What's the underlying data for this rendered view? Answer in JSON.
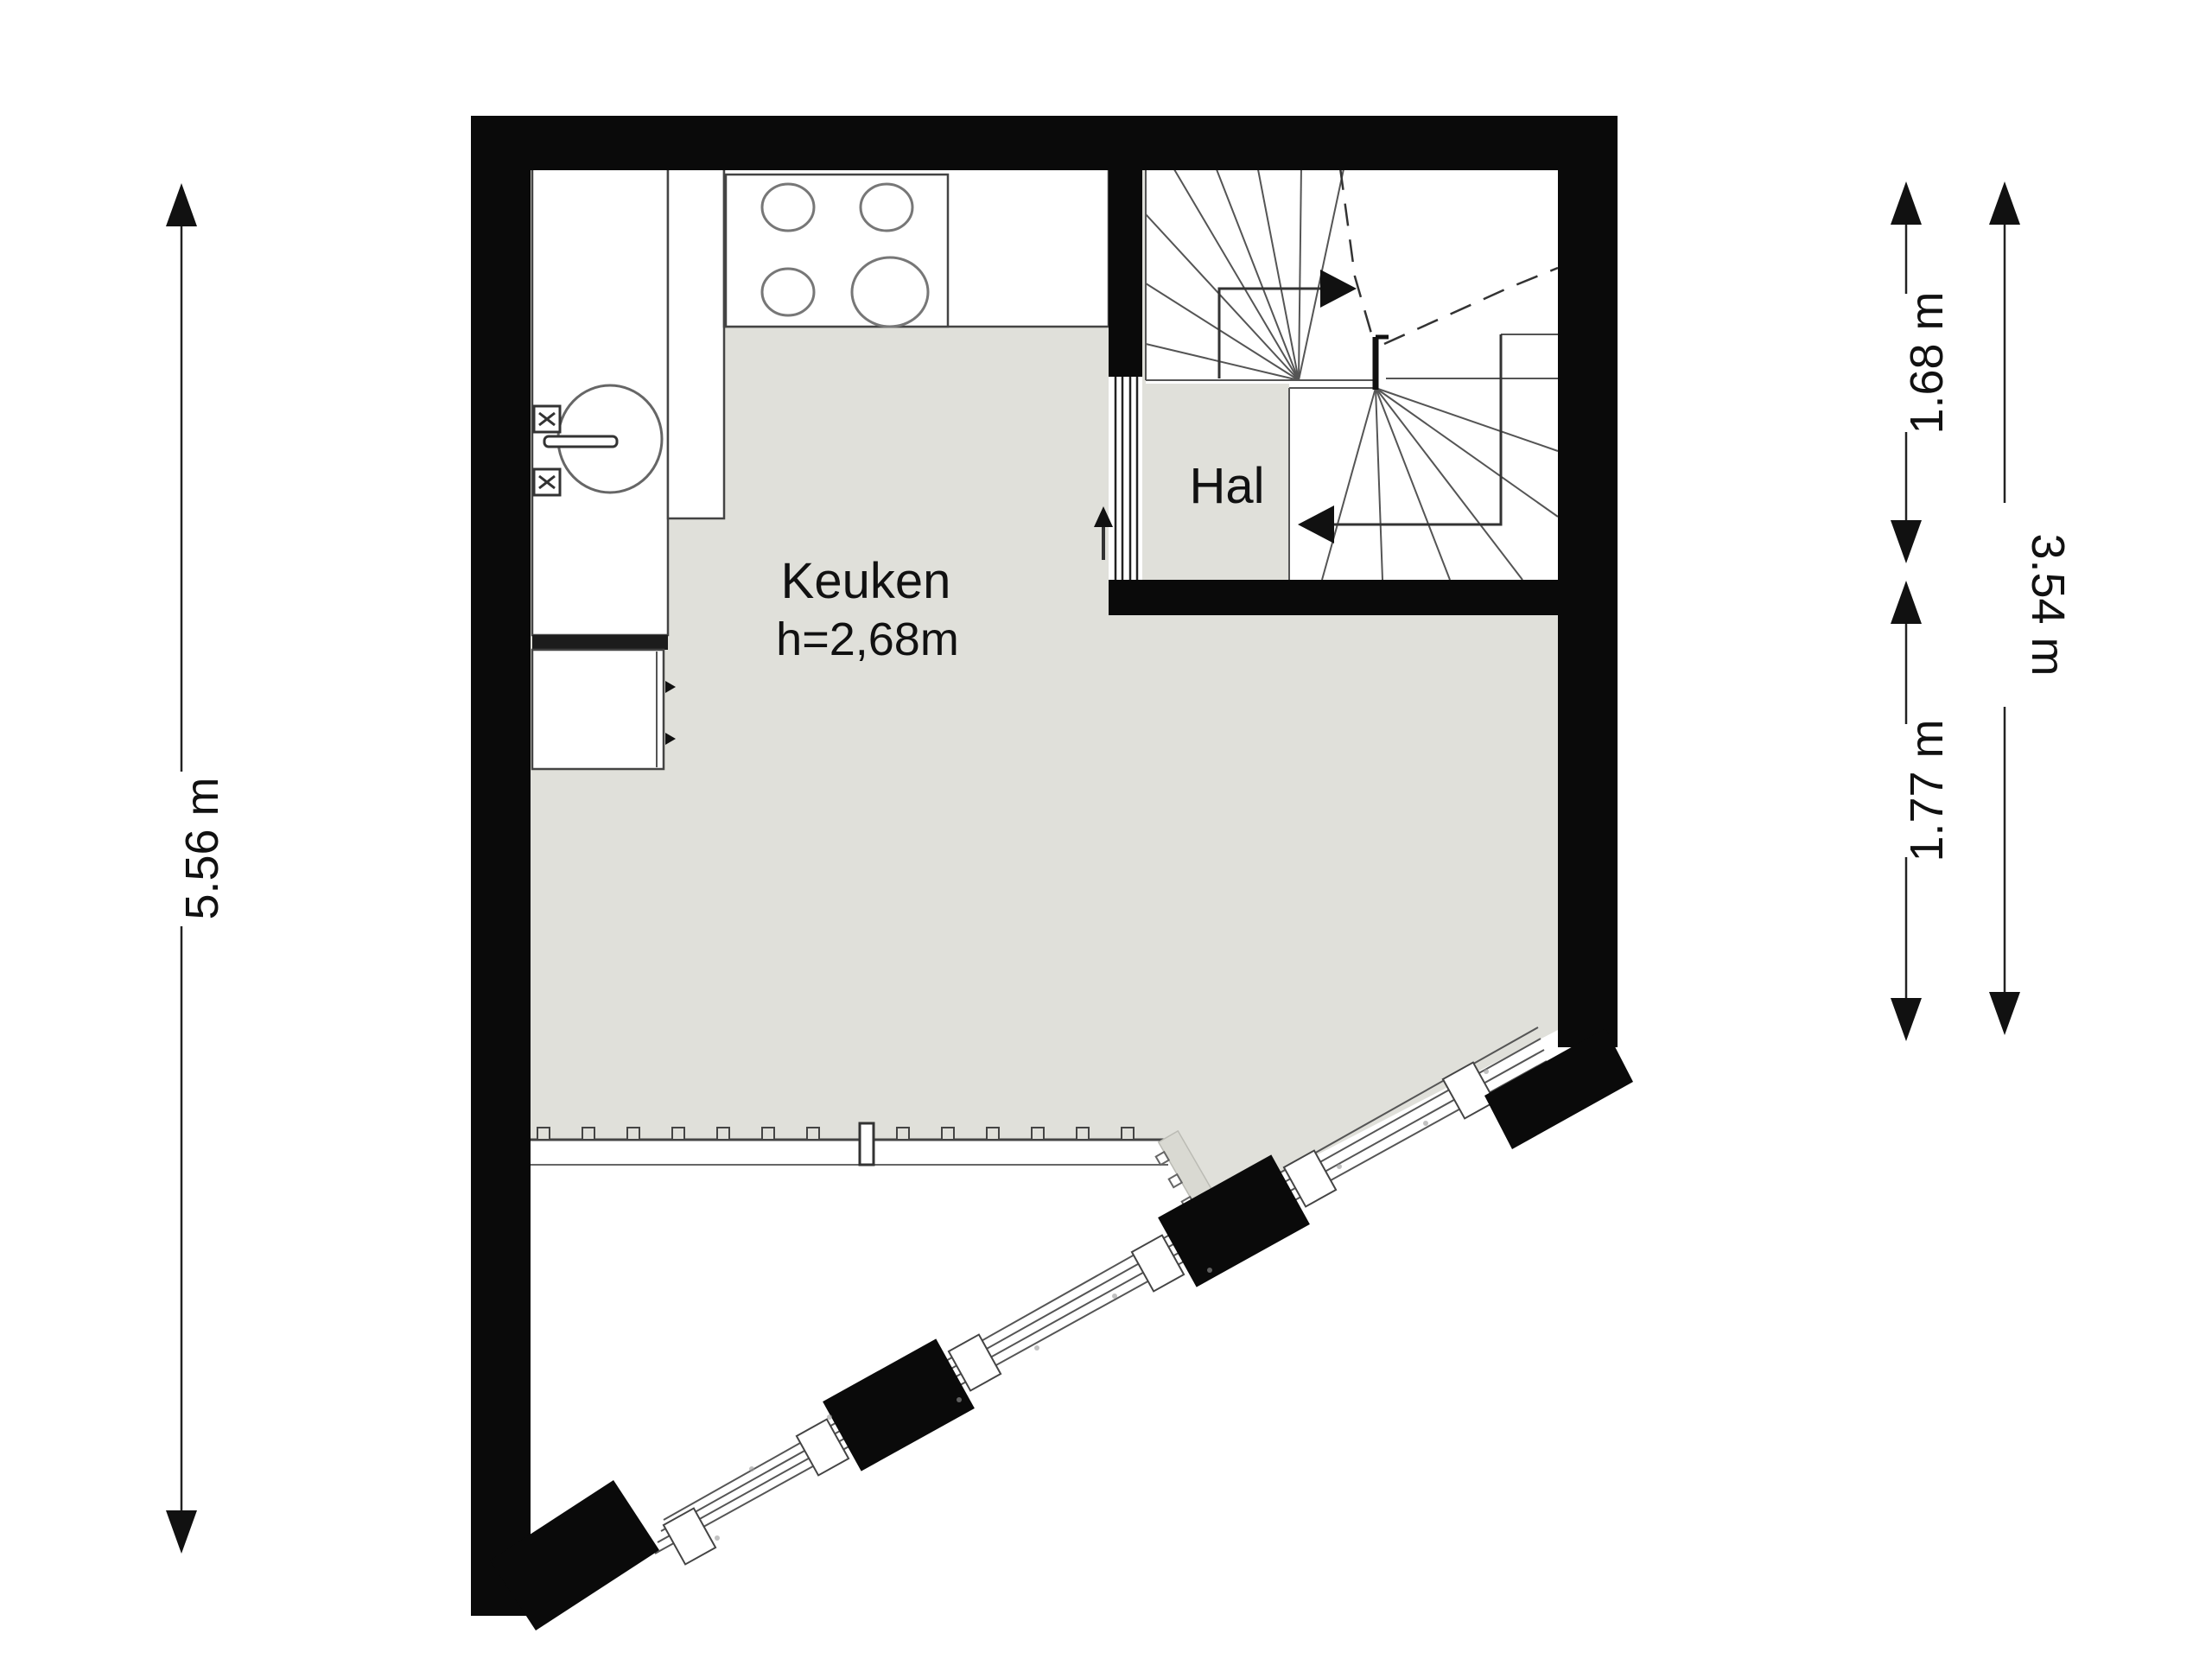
{
  "rooms": {
    "kitchen": {
      "name": "Keuken",
      "height_label": "h=2,68m"
    },
    "hall": {
      "name": "Hal"
    }
  },
  "dimensions": {
    "left_total": "5.56 m",
    "right_stair_block": "1.68 m",
    "right_lower_part": "1.77 m",
    "right_total": "3.54 m"
  },
  "colors": {
    "background": "#ffffff",
    "floor": "#e0e0da",
    "wall": "#0a0a0a",
    "line": "#555555",
    "sill_bar": "#d9d9d2",
    "text": "#111111"
  },
  "icons": {
    "entry_arrow": "up-arrow",
    "stair_up_arrow": "right-arrow",
    "stair_down_arrow": "left-arrow"
  },
  "fixtures": {
    "stove_burner_count": 4,
    "window_tick_count": 14
  }
}
